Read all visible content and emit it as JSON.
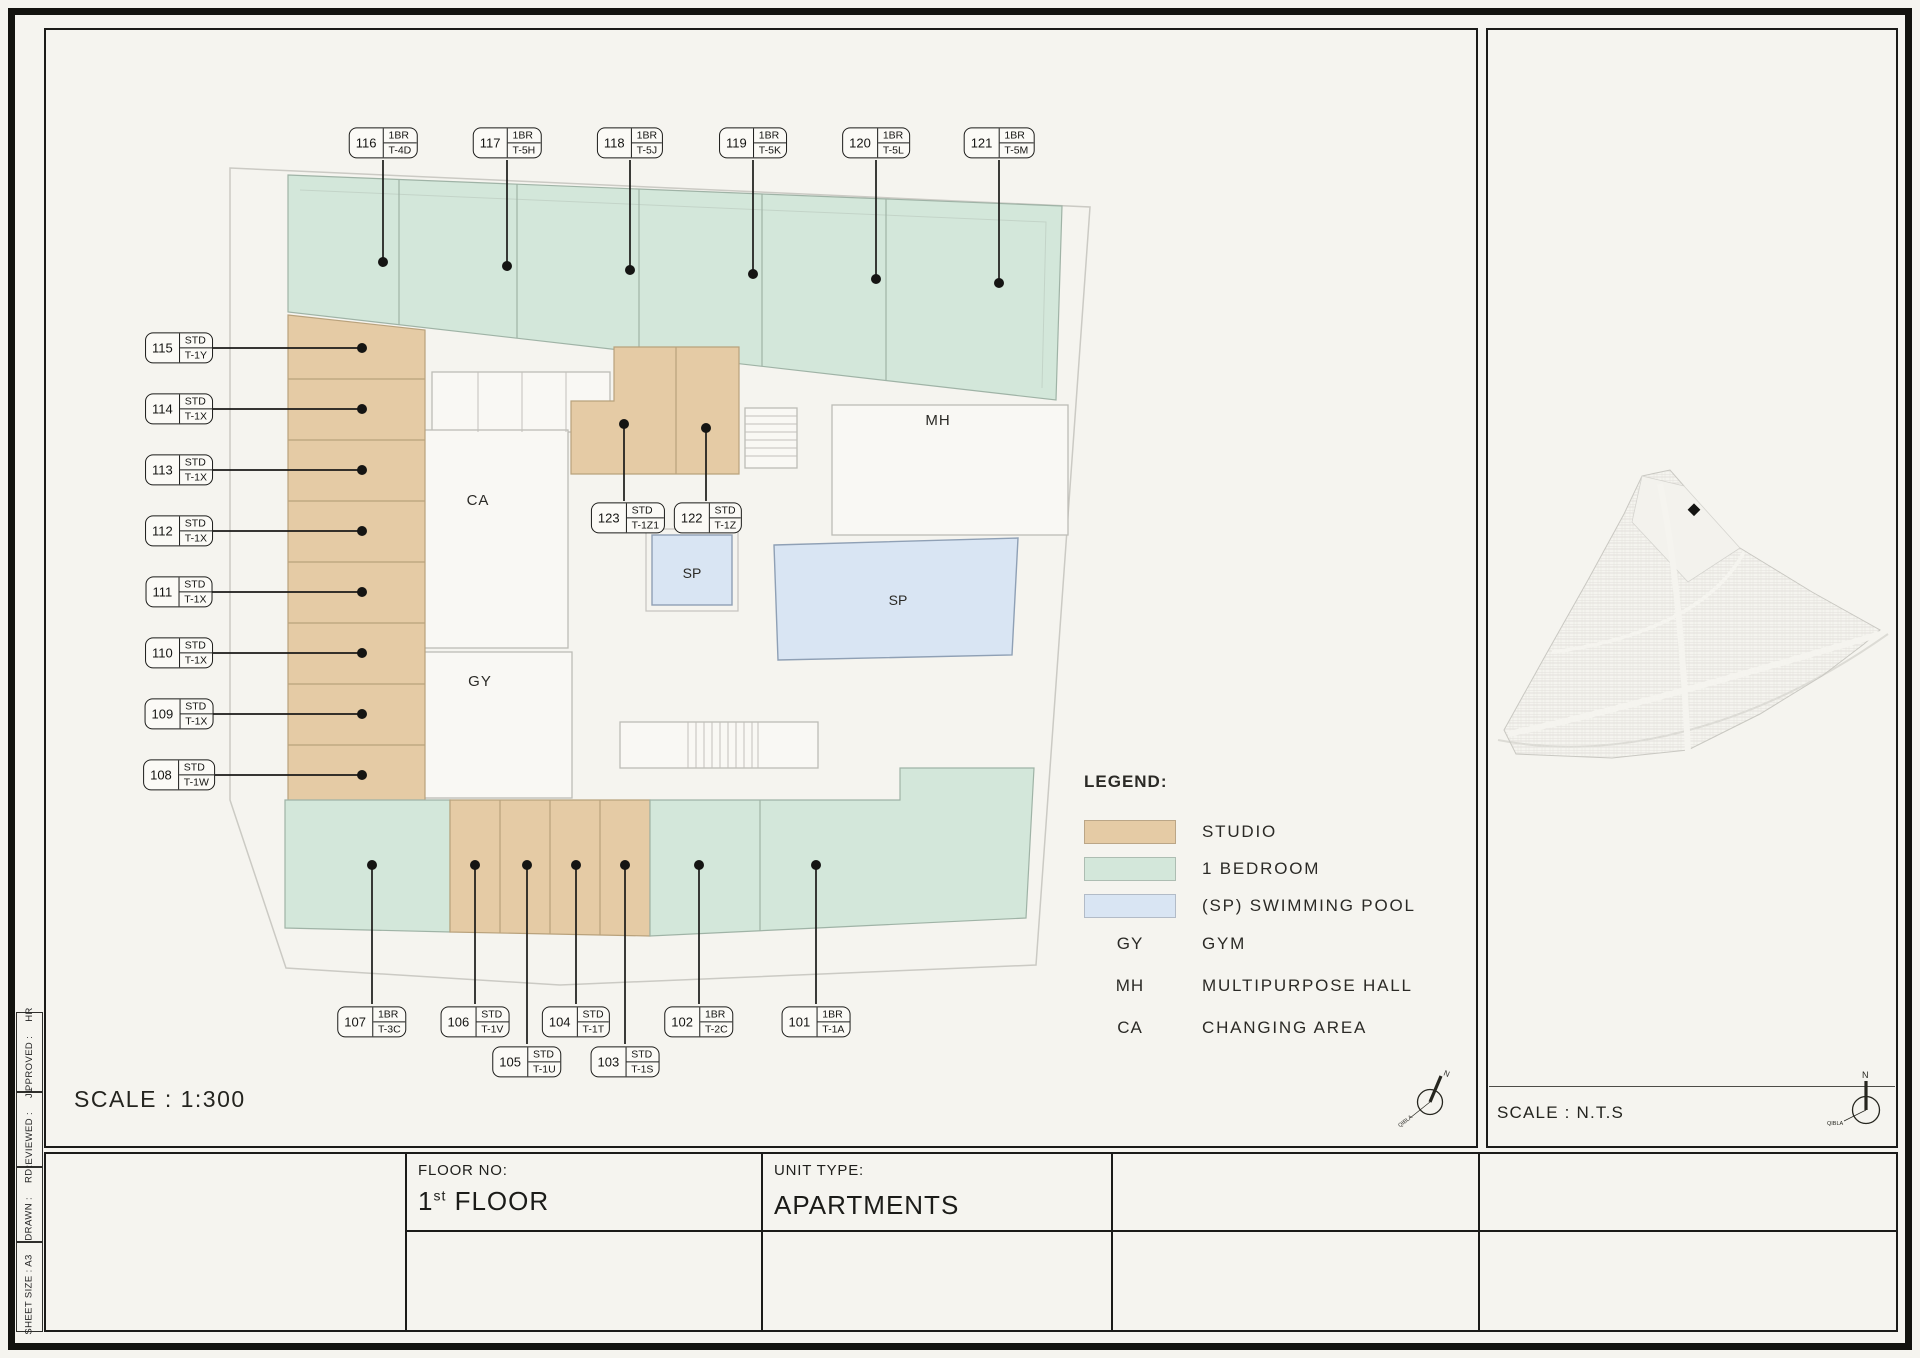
{
  "sheet": {
    "scale_main": "SCALE : 1:300",
    "scale_side": "SCALE : N.T.S",
    "title_block": {
      "floor_label": "FLOOR NO:",
      "floor_value_num": "1",
      "floor_value_sup": "st",
      "floor_value_rest": " FLOOR",
      "unit_type_label": "UNIT TYPE:",
      "unit_type_value": "APARTMENTS"
    },
    "sidebar": [
      {
        "label": "APPROVED :",
        "value": "HR"
      },
      {
        "label": "REVIEWED :",
        "value": "JL"
      },
      {
        "label": "DRAWN :",
        "value": "RD"
      },
      {
        "label": "SHEET SIZE : A3",
        "value": ""
      }
    ]
  },
  "legend": {
    "title": "LEGEND:",
    "swatches": [
      {
        "label": "STUDIO",
        "color": "#e5cba5"
      },
      {
        "label": "1 BEDROOM",
        "color": "#d3e7da"
      },
      {
        "label": "(SP) SWIMMING POOL",
        "color": "#d9e5f3"
      }
    ],
    "abbreviations": [
      {
        "abbr": "GY",
        "label": "GYM"
      },
      {
        "abbr": "MH",
        "label": "MULTIPURPOSE HALL"
      },
      {
        "abbr": "CA",
        "label": "CHANGING AREA"
      }
    ]
  },
  "rooms": {
    "changing_area": "CA",
    "gym": "GY",
    "multipurpose_hall": "MH",
    "pool_small": "SP",
    "pool_large": "SP"
  },
  "compass": {
    "north": "N",
    "qibla": "QIBLA"
  },
  "units": {
    "top": [
      {
        "no": "116",
        "type": "1BR",
        "code": "T-4D"
      },
      {
        "no": "117",
        "type": "1BR",
        "code": "T-5H"
      },
      {
        "no": "118",
        "type": "1BR",
        "code": "T-5J"
      },
      {
        "no": "119",
        "type": "1BR",
        "code": "T-5K"
      },
      {
        "no": "120",
        "type": "1BR",
        "code": "T-5L"
      },
      {
        "no": "121",
        "type": "1BR",
        "code": "T-5M"
      }
    ],
    "left": [
      {
        "no": "115",
        "type": "STD",
        "code": "T-1Y"
      },
      {
        "no": "114",
        "type": "STD",
        "code": "T-1X"
      },
      {
        "no": "113",
        "type": "STD",
        "code": "T-1X"
      },
      {
        "no": "112",
        "type": "STD",
        "code": "T-1X"
      },
      {
        "no": "111",
        "type": "STD",
        "code": "T-1X"
      },
      {
        "no": "110",
        "type": "STD",
        "code": "T-1X"
      },
      {
        "no": "109",
        "type": "STD",
        "code": "T-1X"
      },
      {
        "no": "108",
        "type": "STD",
        "code": "T-1W"
      }
    ],
    "middle": [
      {
        "no": "123",
        "type": "STD",
        "code": "T-1Z1"
      },
      {
        "no": "122",
        "type": "STD",
        "code": "T-1Z"
      }
    ],
    "bottom": [
      {
        "no": "107",
        "type": "1BR",
        "code": "T-3C"
      },
      {
        "no": "106",
        "type": "STD",
        "code": "T-1V"
      },
      {
        "no": "105",
        "type": "STD",
        "code": "T-1U"
      },
      {
        "no": "104",
        "type": "STD",
        "code": "T-1T"
      },
      {
        "no": "103",
        "type": "STD",
        "code": "T-1S"
      },
      {
        "no": "102",
        "type": "1BR",
        "code": "T-2C"
      },
      {
        "no": "101",
        "type": "1BR",
        "code": "T-1A"
      }
    ]
  }
}
